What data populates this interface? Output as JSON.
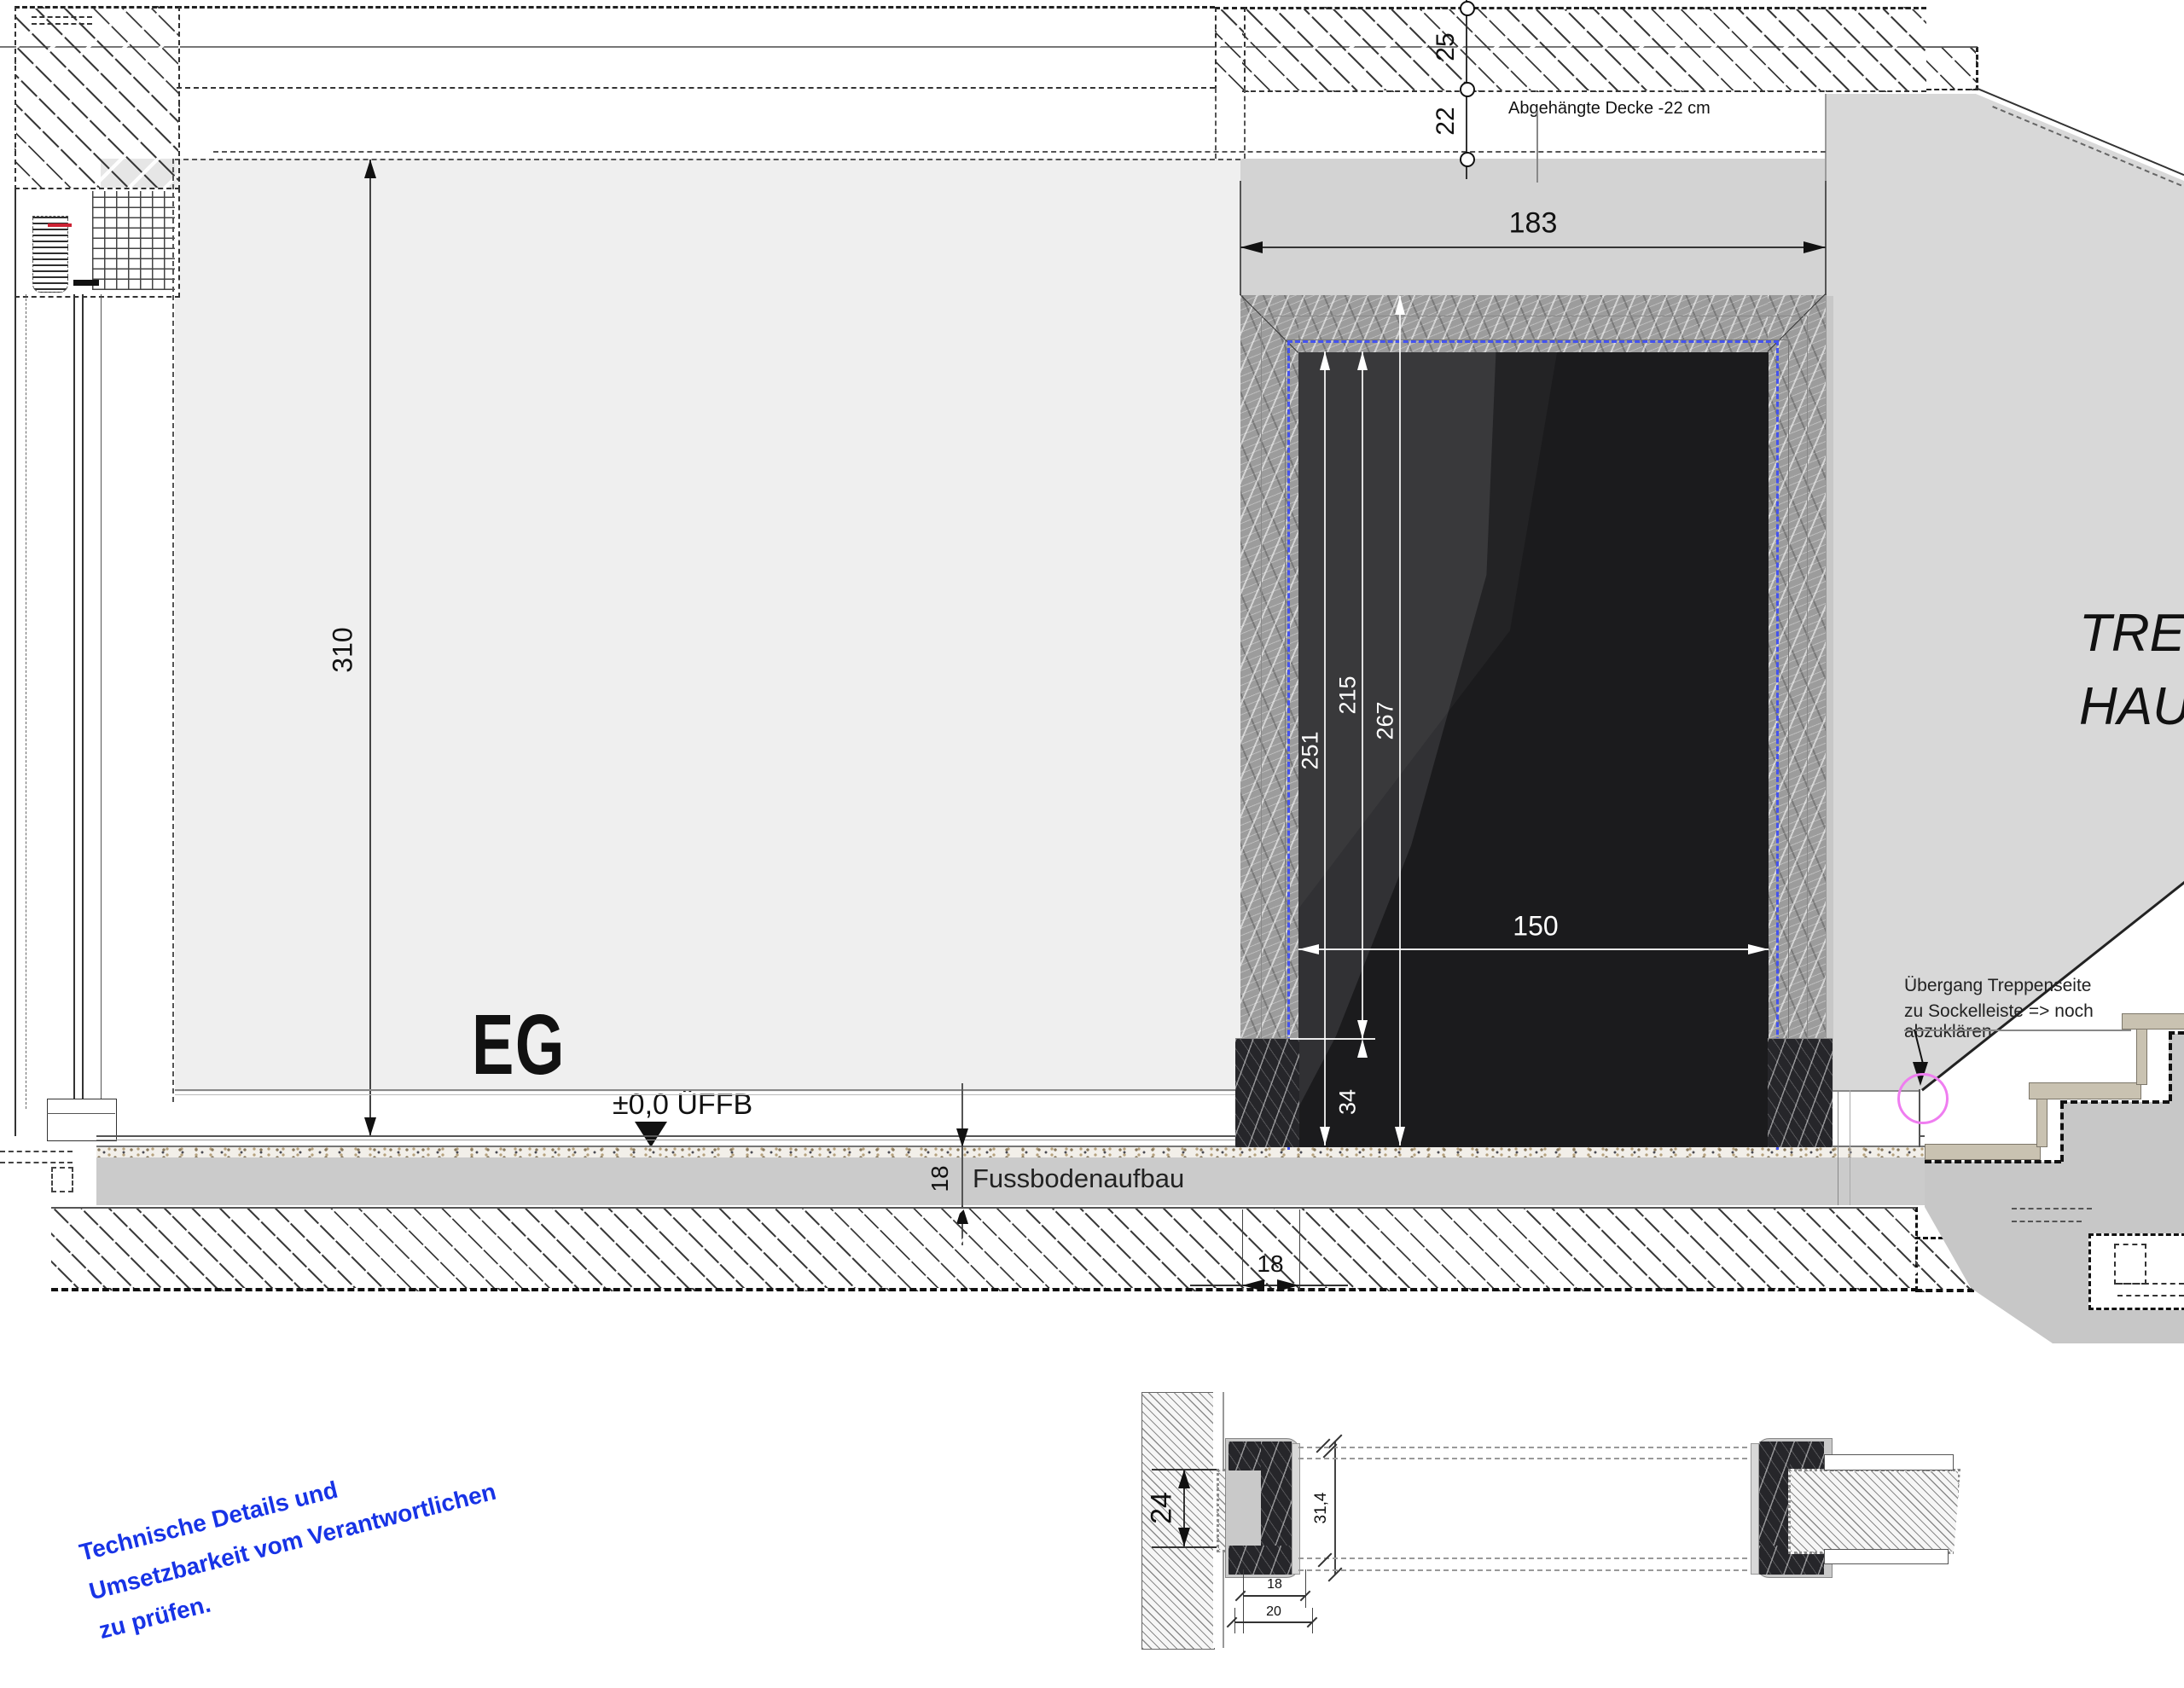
{
  "drawing": {
    "room_label": "EG",
    "level_marker": "±0,0 ÜFFB",
    "ceiling_note": "Abgehängte Decke  -22 cm",
    "floor_note": "Fussbodenaufbau",
    "stair_hall_line1": "TREPPEN",
    "stair_hall_line2": "HAUS",
    "stair_note_line1": "Übergang Treppenseite",
    "stair_note_line2": "zu Sockelleiste => noch abzuklären",
    "review_line1": "Technische Details und",
    "review_line2": "Umsetzbarkeit vom Verantwortlichen",
    "review_line3": "zu prüfen.",
    "dims": {
      "slab": "25",
      "void": "22",
      "room_height": "310",
      "door_width_outer": "183",
      "door_width_clear": "150",
      "door_h_clear": "251",
      "door_h_base": "215",
      "door_h_outer": "267",
      "base_block": "34",
      "floor_buildup": "18",
      "wall_return": "18",
      "detail_wall": "24",
      "detail_frame_depth": "31,4",
      "detail_small_a": "18",
      "detail_small_b": "20"
    },
    "colors": {
      "note_blue": "#1733e6",
      "frame_dash_blue": "#4453ef",
      "highlight_magenta": "#ef7df0"
    }
  }
}
